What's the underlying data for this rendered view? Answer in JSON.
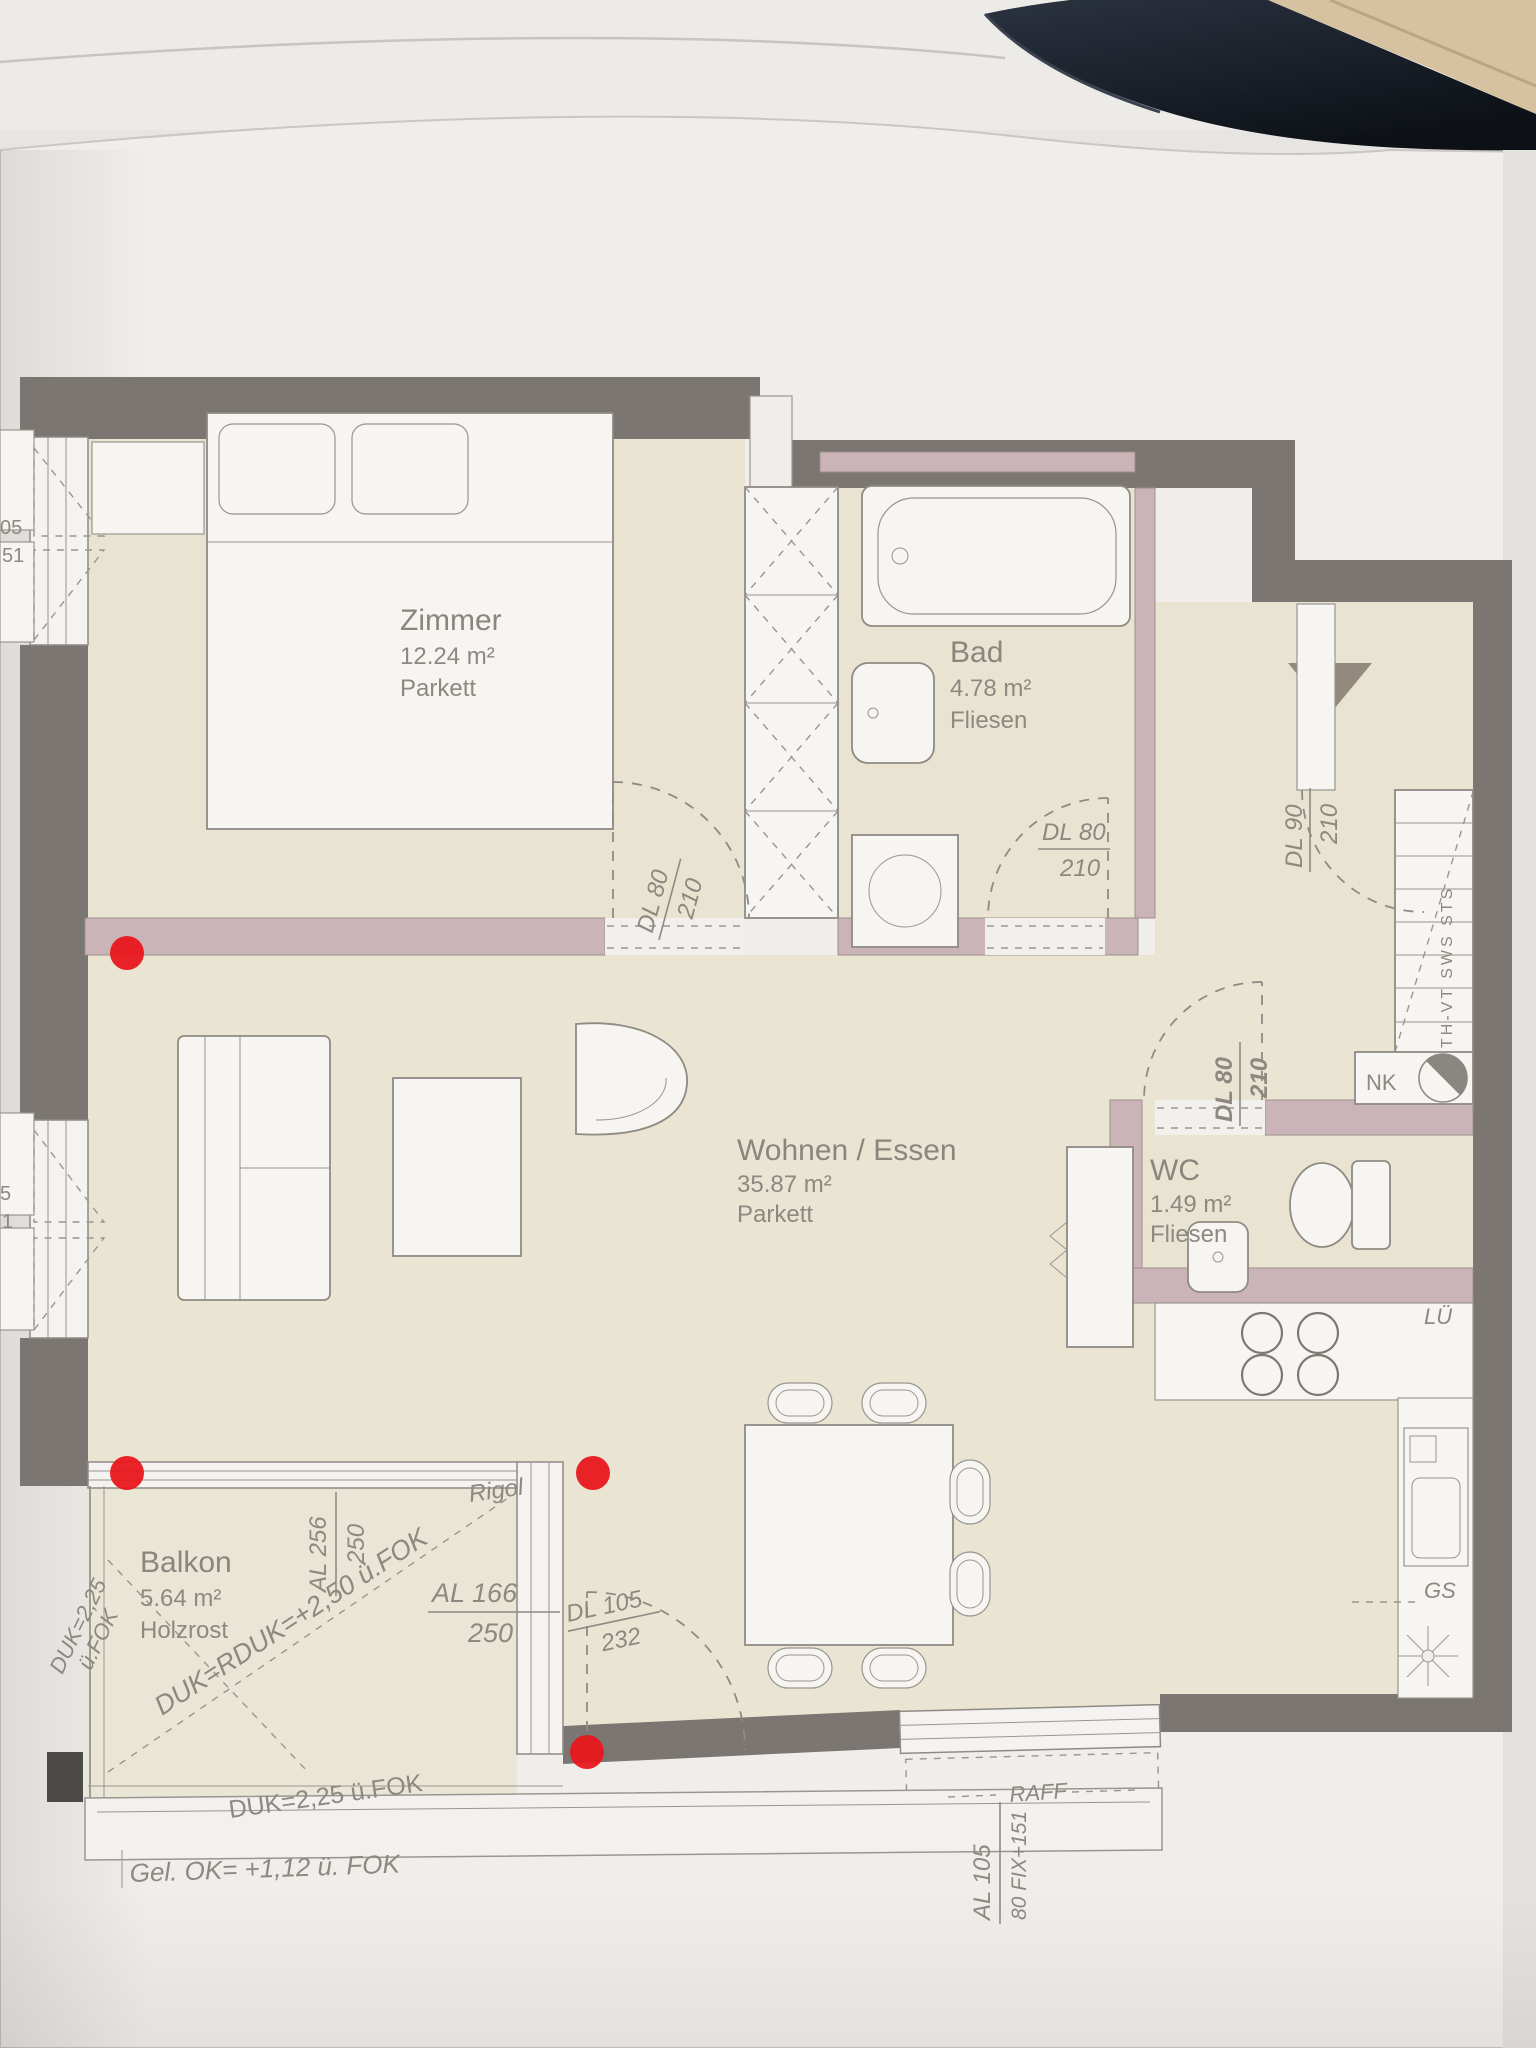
{
  "rooms": [
    {
      "name": "Zimmer",
      "area": "12.24 m²",
      "floor": "Parkett"
    },
    {
      "name": "Bad",
      "area": "4.78 m²",
      "floor": "Fliesen"
    },
    {
      "name": "Wohnen / Essen",
      "area": "35.87 m²",
      "floor": "Parkett"
    },
    {
      "name": "WC",
      "area": "1.49 m²",
      "floor": "Fliesen"
    },
    {
      "name": "Balkon",
      "area": "5.64 m²",
      "floor": "Holzrost"
    }
  ],
  "doors": [
    {
      "id": "zimmer-door",
      "label": "DL 80",
      "size": "210"
    },
    {
      "id": "bad-door",
      "label": "DL 80",
      "size": "210"
    },
    {
      "id": "entrance-door",
      "label": "DL 90",
      "size": "210"
    },
    {
      "id": "wc-door",
      "label": "DL 80",
      "size": "210"
    },
    {
      "id": "balcony-door",
      "label": "DL 105",
      "size": "232"
    }
  ],
  "windows": [
    {
      "id": "balcony-window",
      "label": "AL 256",
      "size": "250"
    },
    {
      "id": "balcony-side-window",
      "label": "AL 166",
      "size": "250"
    },
    {
      "id": "south-window",
      "label": "AL 105",
      "size": "80 FIX+151"
    }
  ],
  "annotations": {
    "duk_diagonal": "DUK=RDUK=+2,50 ü.FOK",
    "duk_left1": "DUK=2,25",
    "duk_left2": "ü.FOK",
    "duk_bottom": "DUK=2,25 ü.FOK",
    "ground_level": "Gel. OK= +1,12 ü. FOK",
    "rigol": "Rigol",
    "raff": "RAFF",
    "nk": "NK",
    "lue": "LÜ",
    "gs": "GS",
    "shaft": "TH-VT SWS STS",
    "fragments": [
      "05",
      "51",
      "5",
      "1"
    ]
  },
  "markers": {
    "color": "#e8171c",
    "count": 4
  },
  "palette": {
    "wall_dark": "#7b7671",
    "wall_mauve": "#cbb4b8",
    "floor_beige": "#e9e4d1",
    "paper": "#f0eeeb",
    "red": "#e8171c"
  }
}
